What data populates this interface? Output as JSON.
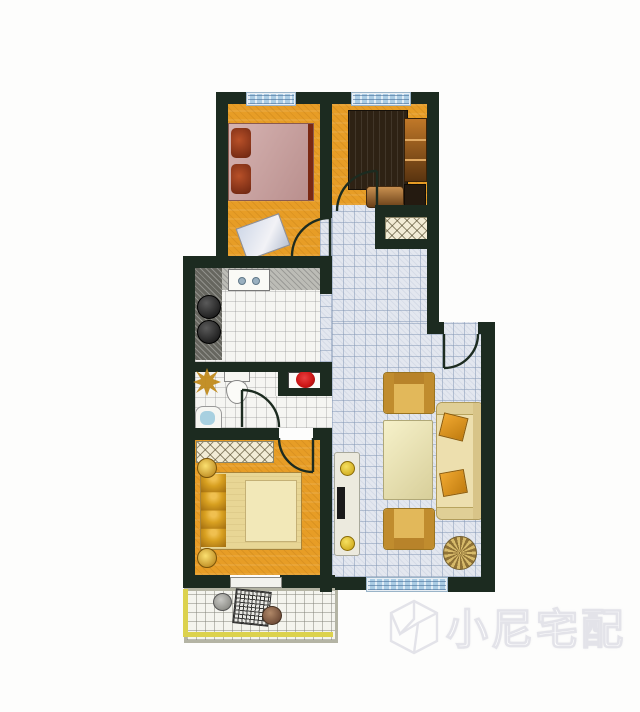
{
  "watermark": {
    "text": "小尼宅配",
    "logo": "cube-n-logo"
  },
  "palette": {
    "wall": "#1c2b20",
    "floor-orange": "#e79d26",
    "tile-blue": "#e3e7ef",
    "tile-grid": "#8296b4",
    "floor-white": "#f5f5f2",
    "window-glass": "#aacce4",
    "accent-yellow": "#dcd24e",
    "bed-pink": "#c89a98",
    "pillow-red": "#9a3a18",
    "gold": "#d8a020",
    "sofa-cream": "#eddfae",
    "flower-red": "#cc1616",
    "counter-dark": "#66665f"
  }
}
